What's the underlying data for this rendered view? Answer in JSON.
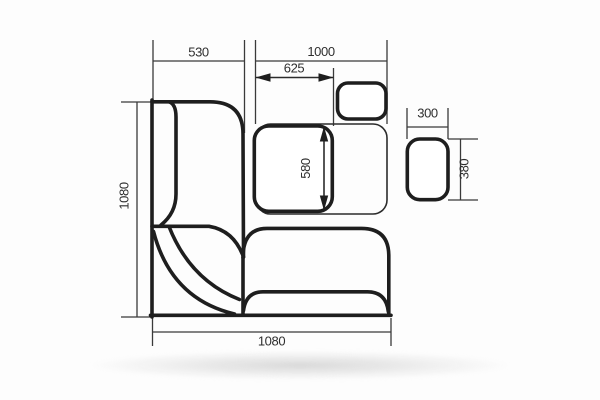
{
  "drawing": {
    "type": "furniture-top-view-dimension-drawing",
    "subject": "corner-bench-with-table-and-stools",
    "units": "mm",
    "colors": {
      "line": "#1e1e1e",
      "thin_line": "#3a3a3a",
      "text": "#2e2e2e",
      "background": "#fdfdfd",
      "fill": "#ffffff"
    },
    "dimensions": {
      "left_bench_width": "530",
      "right_section_width": "1000",
      "table_width": "625",
      "table_depth": "580",
      "left_side_depth": "1080",
      "bottom_side_width": "1080",
      "stool_width": "300",
      "stool_depth": "380"
    },
    "parts": [
      "left-bench-seat",
      "left-bench-backrest",
      "corner-seat",
      "corner-backrest",
      "bottom-bench-seat",
      "bottom-bench-backrest",
      "dining-table",
      "table-outline-thin",
      "stool-top",
      "stool-right"
    ]
  }
}
